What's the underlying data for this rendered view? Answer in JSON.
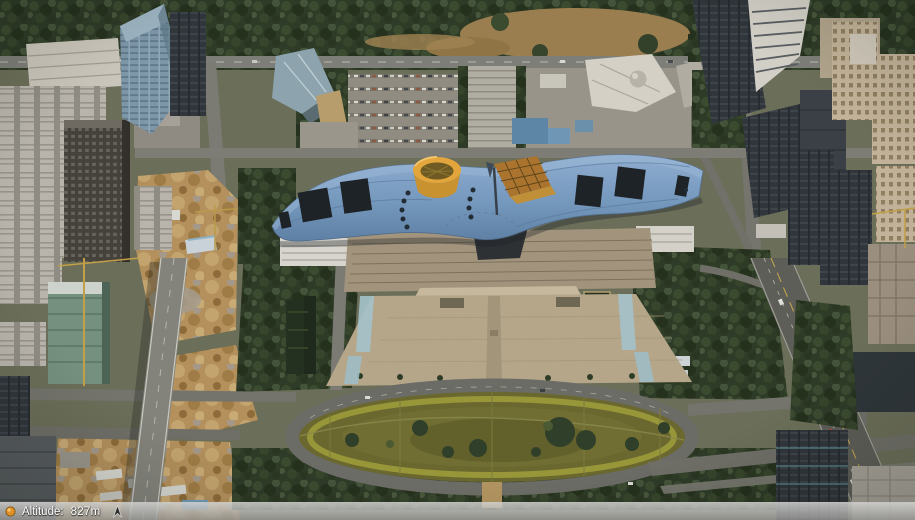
{
  "status_bar": {
    "altitude_label": "Altitude:",
    "altitude_value": "827m"
  },
  "scene": {
    "type": "3d-aerial-city-view",
    "landmarks": [
      "civic-center-wave-roof",
      "yellow-cylinder-pavilion",
      "orange-pyramid-pavilion",
      "civic-plaza",
      "oval-lawn-park",
      "north-hill-park",
      "southeast-highway",
      "west-elevated-road",
      "west-construction-sites",
      "west-residential-towers",
      "east-office-towers"
    ]
  },
  "palette": {
    "roof_blue": "#7598bd",
    "cylinder_yellow": "#e2a63c",
    "pyramid_orange": "#ab742e",
    "plaza_beige": "#b5a689",
    "park_olive": "#6a672f",
    "park_rim": "#9c9b3a",
    "hill_tan": "#9b7e50",
    "tree_dark": "#2e3b27",
    "road_gray": "#74746d",
    "highway_gray": "#5e5e58",
    "dirt_tan": "#b3905c",
    "status_dot_orange": "#e0912c"
  }
}
